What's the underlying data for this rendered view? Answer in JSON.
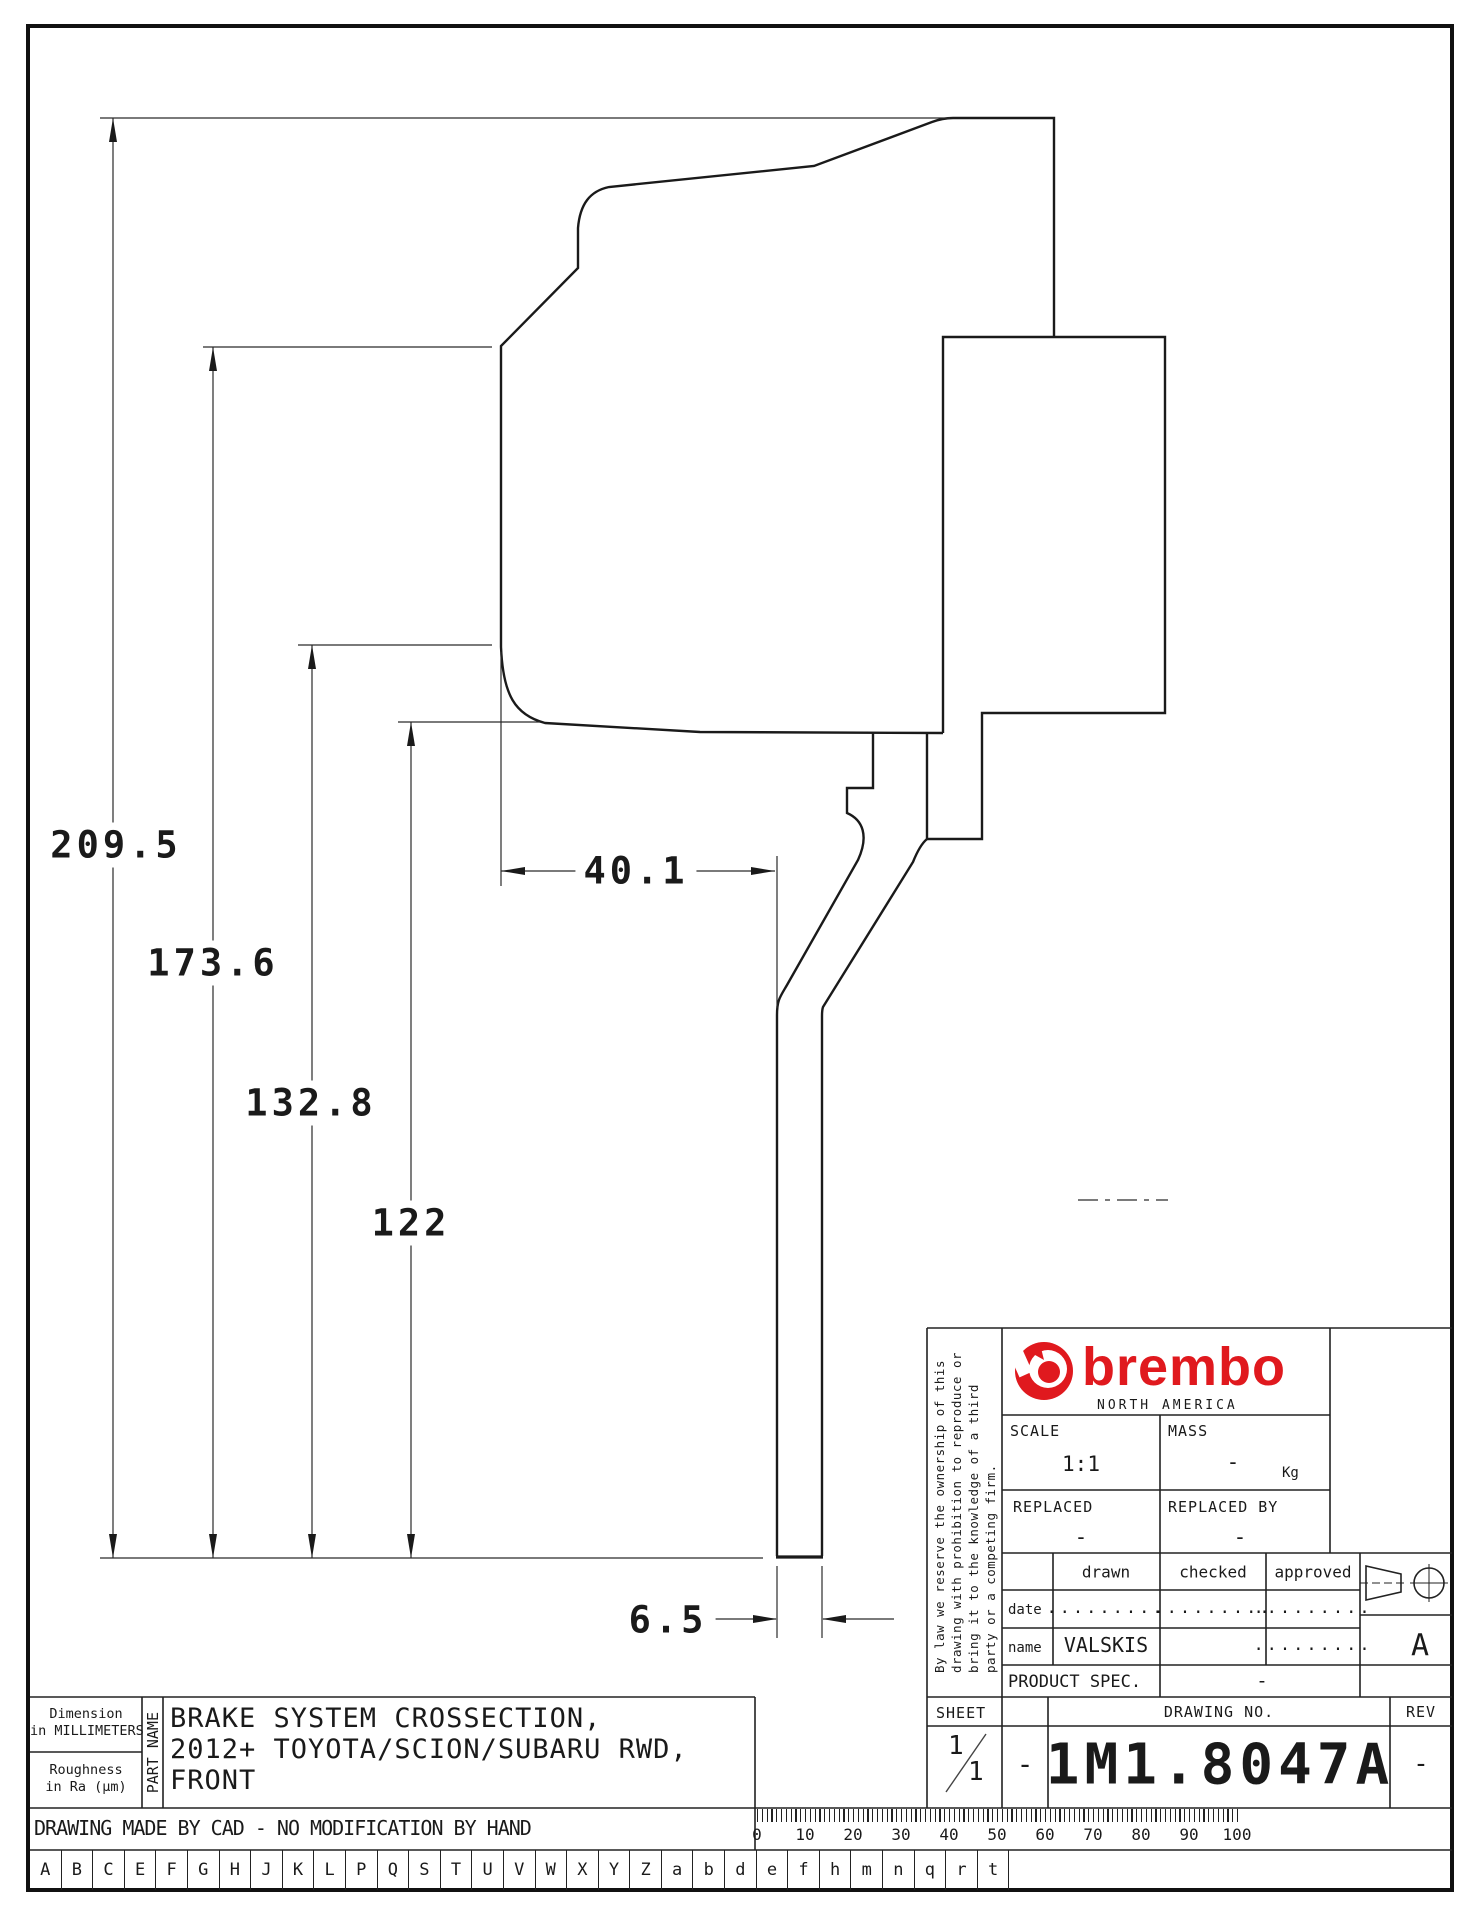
{
  "drawing": {
    "dim_209_5": "209.5",
    "dim_173_6": "173.6",
    "dim_132_8": "132.8",
    "dim_122": "122",
    "dim_40_1": "40.1",
    "dim_6_5": "6.5"
  },
  "title_block": {
    "legal_notice_lines": [
      "By law we reserve the ownership of this",
      "drawing with prohibition to reproduce or",
      "bring it to the knowledge of a third",
      "party or a competing firm."
    ],
    "brand": {
      "word": "brembo",
      "subtitle": "NORTH AMERICA",
      "color": "#e0191e"
    },
    "scale_label": "SCALE",
    "scale_value": "1:1",
    "mass_label": "MASS",
    "mass_value": "-",
    "mass_unit": "Kg",
    "replaced_label": "REPLACED",
    "replaced_value": "-",
    "replaced_by_label": "REPLACED BY",
    "replaced_by_value": "-",
    "sign_table": {
      "drawn_label": "drawn",
      "checked_label": "checked",
      "approved_label": "approved",
      "date_label": "date",
      "name_label": "name",
      "date_drawn": ".........",
      "date_checked": ".........",
      "date_approved": ".........",
      "name_drawn": "VALSKIS",
      "name_checked": "",
      "name_approved": "........."
    },
    "product_spec_label": "PRODUCT SPEC.",
    "product_spec_value": "-",
    "sheet_label": "SHEET",
    "sheet_num": "1",
    "sheet_total": "1",
    "sheet_dash": "-",
    "drawing_no_label": "DRAWING NO.",
    "drawing_no": "1M1.8047A",
    "rev_label": "REV",
    "rev_value": "-",
    "format_letter": "A"
  },
  "info_block": {
    "dimension_note_line1": "Dimension",
    "dimension_note_line2": "in MILLIMETERS",
    "roughness_line1": "Roughness",
    "roughness_line2": "in Ra (μm)",
    "part_name_label": "PART NAME",
    "part_name_line1": "BRAKE SYSTEM CROSSECTION,",
    "part_name_line2": "2012+ TOYOTA/SCION/SUBARU RWD,",
    "part_name_line3": "FRONT"
  },
  "footer": {
    "cad_note": "DRAWING MADE BY CAD - NO MODIFICATION BY HAND",
    "ruler_labels": [
      "0",
      "10",
      "20",
      "30",
      "40",
      "50",
      "60",
      "70",
      "80",
      "90",
      "100"
    ],
    "letter_cells": [
      "A",
      "B",
      "C",
      "E",
      "F",
      "G",
      "H",
      "J",
      "K",
      "L",
      "P",
      "Q",
      "S",
      "T",
      "U",
      "V",
      "W",
      "X",
      "Y",
      "Z",
      "a",
      "b",
      "d",
      "e",
      "f",
      "h",
      "m",
      "n",
      "q",
      "r",
      "t"
    ]
  }
}
